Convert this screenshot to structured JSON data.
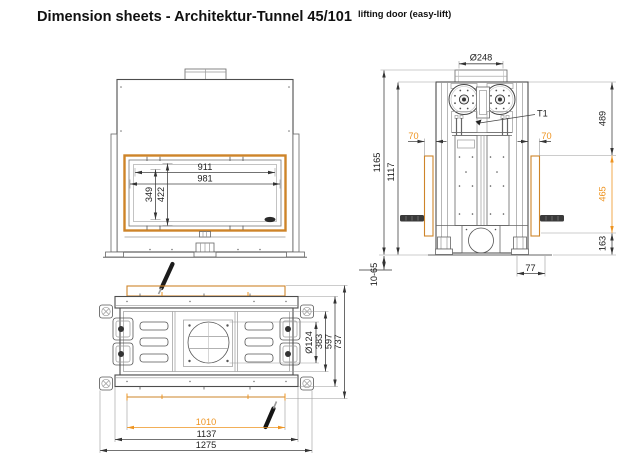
{
  "page": {
    "title": "Dimension sheets - Architektur-Tunnel 45/101",
    "subtitle": "lifting door (easy-lift)"
  },
  "colors": {
    "dimension_accent": "#EE9421",
    "frame_accent": "#CE8429",
    "line_color": "#4d4d4d"
  },
  "front": {
    "dims": {
      "glass_width_inner": "911",
      "glass_width_outer": "981",
      "glass_height_inner": "349",
      "glass_height_outer": "422"
    }
  },
  "side": {
    "labels": {
      "t1": "T1"
    },
    "dims": {
      "flue_diameter": "Ø248",
      "height_top": "489",
      "height_overall": "1165",
      "height_body": "1117",
      "offset_left": "70",
      "offset_right": "70",
      "frame_height": "465",
      "height_base": "163",
      "foot_range": "10-65",
      "base_depth": "77"
    }
  },
  "plan": {
    "dims": {
      "duct_diameter": "Ø124",
      "depth_inner": "383",
      "depth_body": "597",
      "depth_overall": "737",
      "width_frame": "1010",
      "width_body": "1137",
      "width_overall": "1275"
    }
  }
}
